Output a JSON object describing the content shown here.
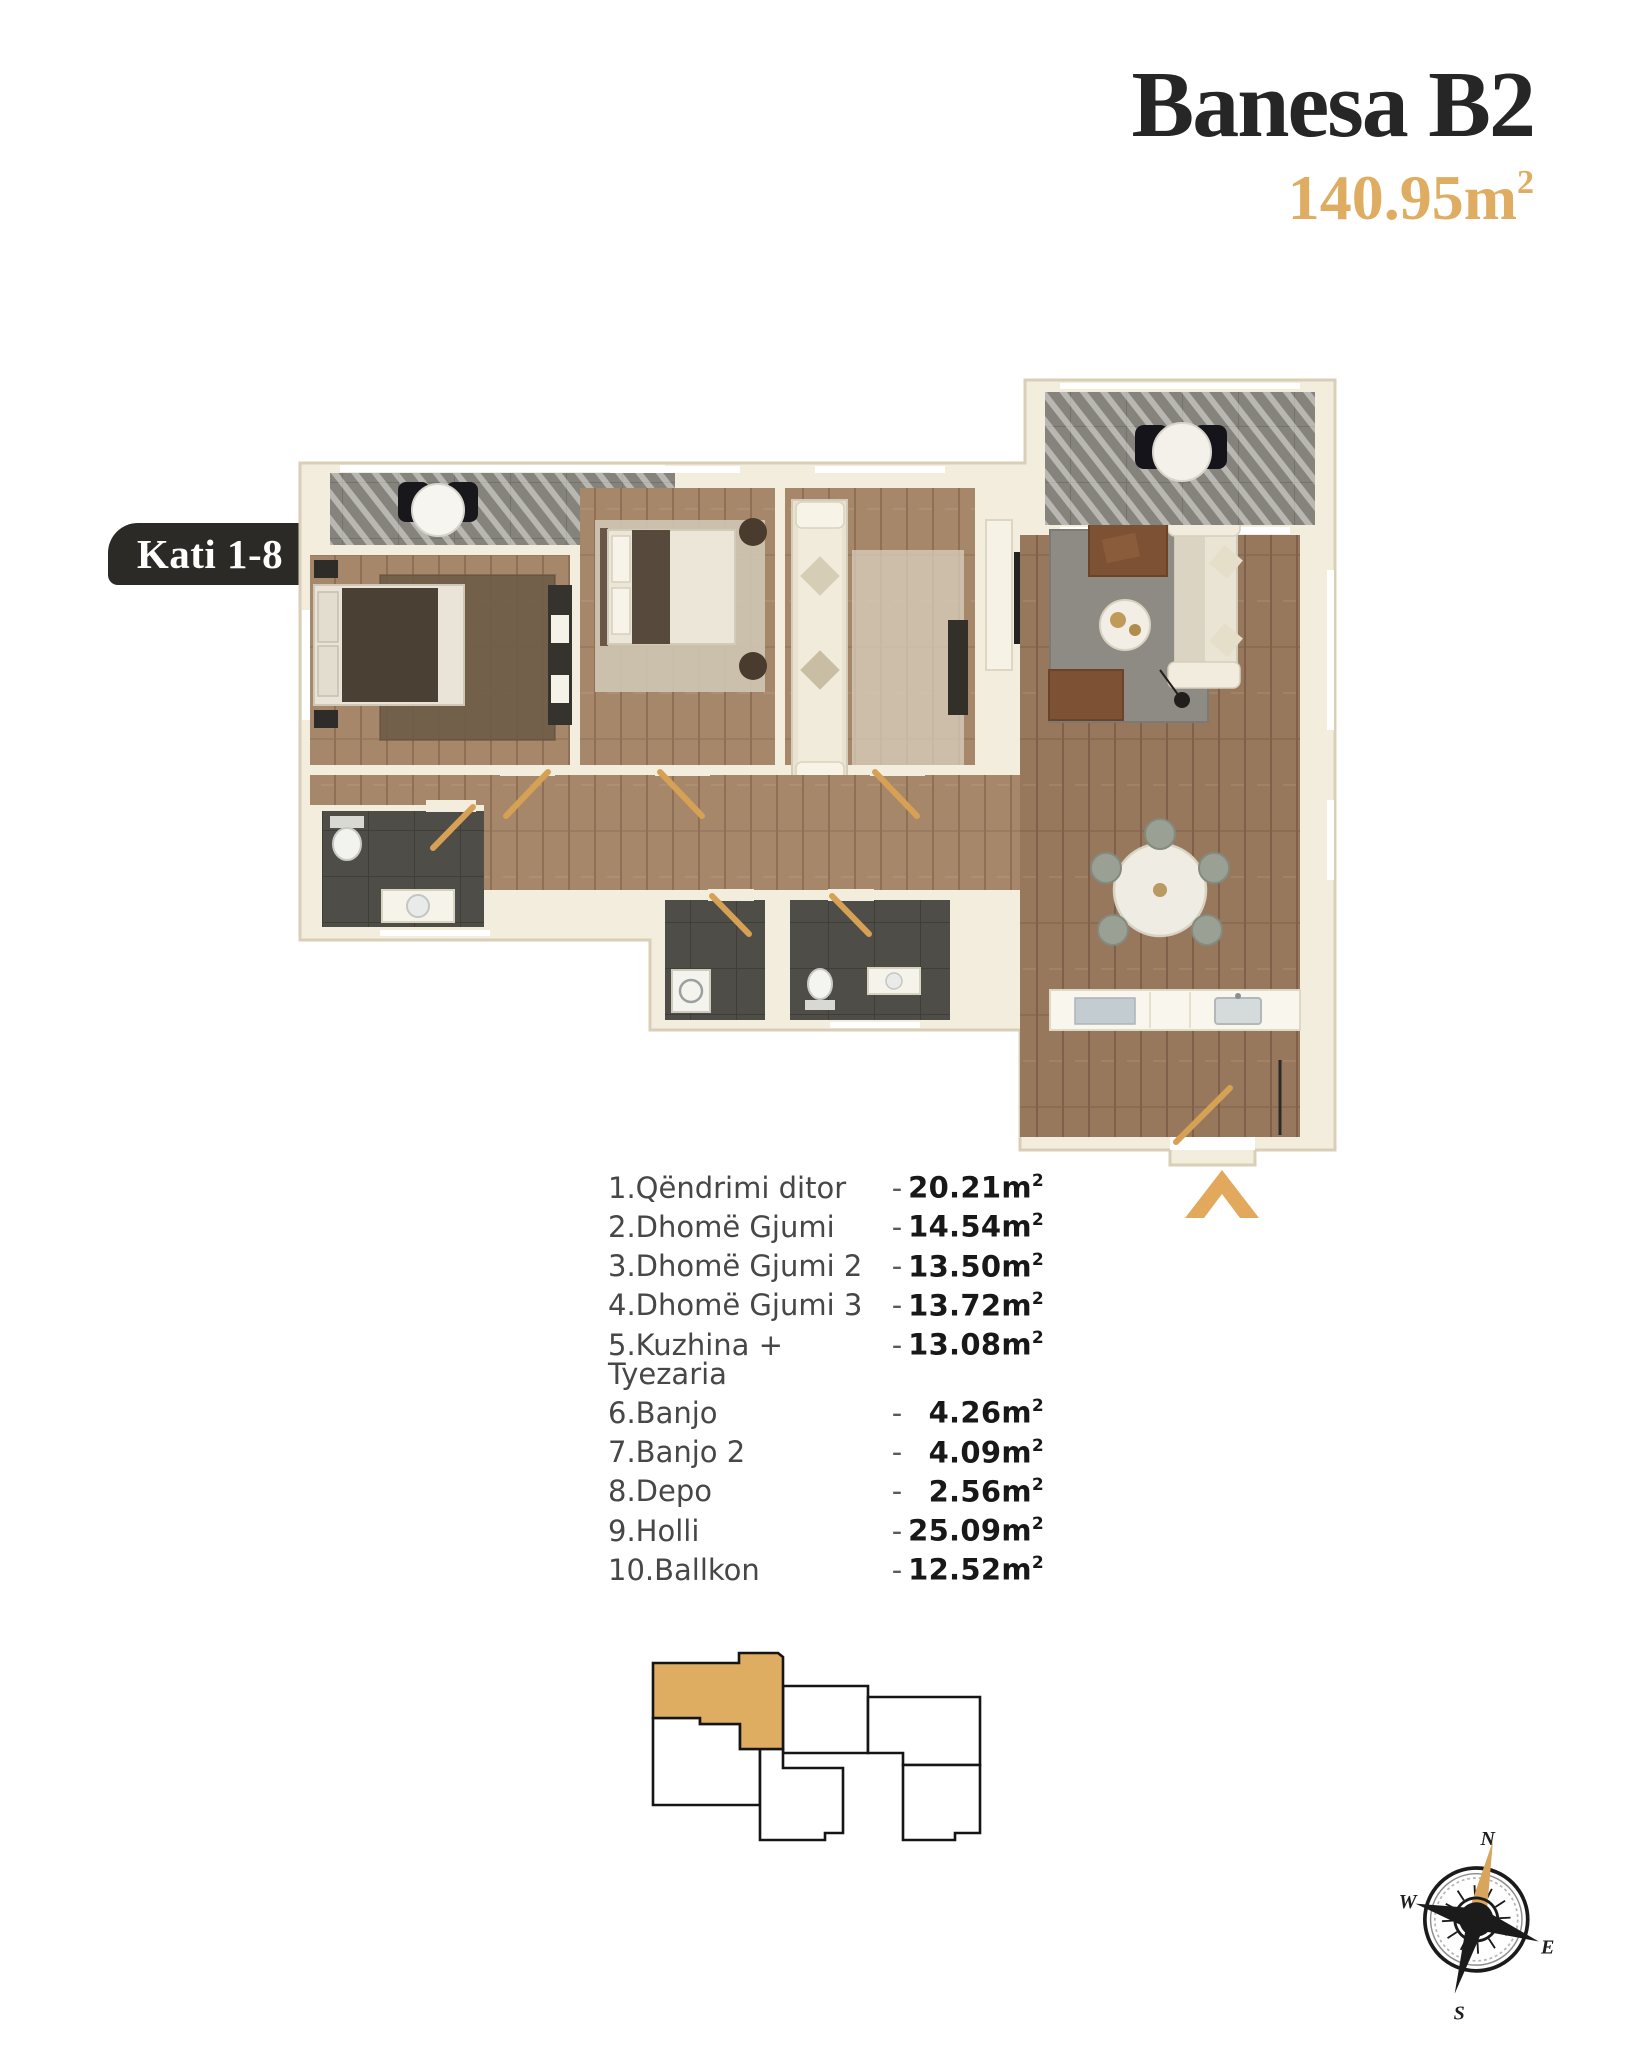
{
  "header": {
    "title": "Banesa B2",
    "area_value": "140.95",
    "area_unit": "m",
    "area_sup": "2"
  },
  "floor_badge": "Kati 1-8",
  "room_list": {
    "dash": "-",
    "unit": "m",
    "sup": "2",
    "rows": [
      {
        "label": "1.Qëndrimi ditor",
        "value": "20.21"
      },
      {
        "label": "2.Dhomë Gjumi",
        "value": "14.54"
      },
      {
        "label": "3.Dhomë Gjumi 2",
        "value": "13.50"
      },
      {
        "label": "4.Dhomë Gjumi 3",
        "value": "13.72"
      },
      {
        "label": "5.Kuzhina + Tyezaria",
        "value": "13.08"
      },
      {
        "label": "6.Banjo",
        "value": "4.26"
      },
      {
        "label": "7.Banjo 2",
        "value": "4.09"
      },
      {
        "label": "8.Depo",
        "value": "2.56"
      },
      {
        "label": "9.Holli",
        "value": "25.09"
      },
      {
        "label": "10.Ballkon",
        "value": "12.52"
      }
    ]
  },
  "compass": {
    "n": "N",
    "e": "E",
    "s": "S",
    "w": "W"
  },
  "colors": {
    "gold": "#DFAD62",
    "ink": "#262626",
    "badge_bg": "#2B2A26",
    "wall_cream": "#F3EDDE",
    "wood": "#A6876A",
    "tile_dark": "#4F4D47",
    "tile_balcony": "#85837B"
  }
}
